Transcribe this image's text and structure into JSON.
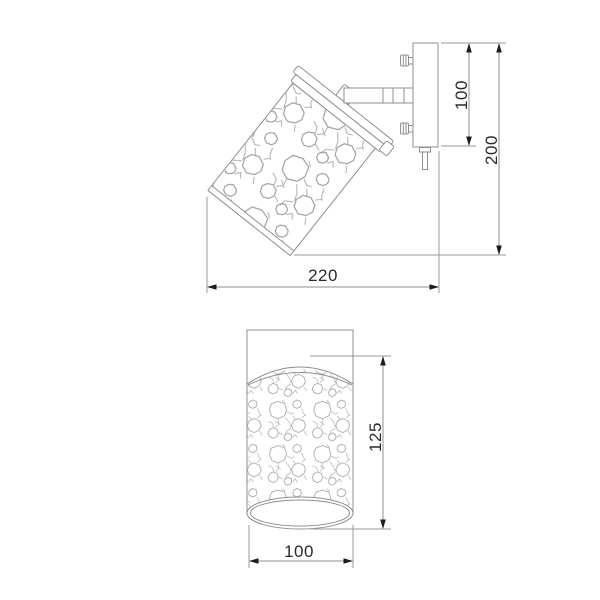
{
  "title": "wall lamp dimension drawing",
  "colors": {
    "line": "#8f8f8f",
    "ink": "#2a2a2a",
    "background": "#ffffff"
  },
  "side_view": {
    "dim_plate_height": "100",
    "dim_total_height": "200",
    "dim_total_width": "220"
  },
  "front_view": {
    "dim_shade_height": "125",
    "dim_shade_diameter": "100"
  }
}
